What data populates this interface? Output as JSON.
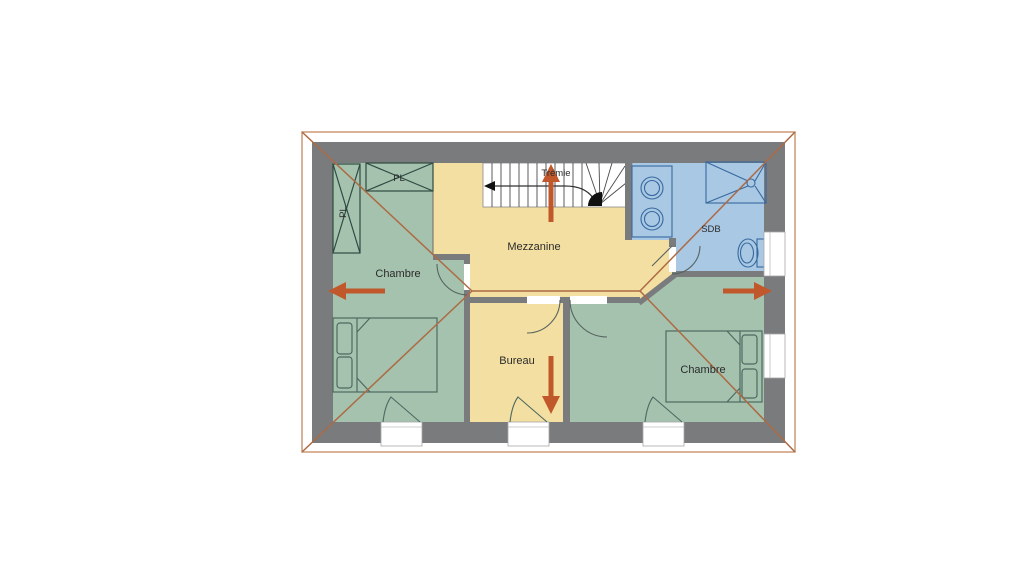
{
  "labels": {
    "chambre_left": "Chambre",
    "chambre_right": "Chambre",
    "mezzanine": "Mezzanine",
    "bureau": "Bureau",
    "sdb": "SDB",
    "tremie": "Trémie",
    "closet_vertical": "PL",
    "closet_horizontal": "PL"
  },
  "colors": {
    "bedroom": "#a4c2ae",
    "mezzanine": "#f3dfa1",
    "bathroom": "#a8c8e4",
    "wall": "#7a7b7d",
    "stair": "#ffffff",
    "roof_line": "#ad6a44",
    "arrow": "#c1582b",
    "frame": "#c9916b"
  },
  "arrows": [
    {
      "direction": "left"
    },
    {
      "direction": "right"
    },
    {
      "direction": "up"
    },
    {
      "direction": "down"
    }
  ]
}
